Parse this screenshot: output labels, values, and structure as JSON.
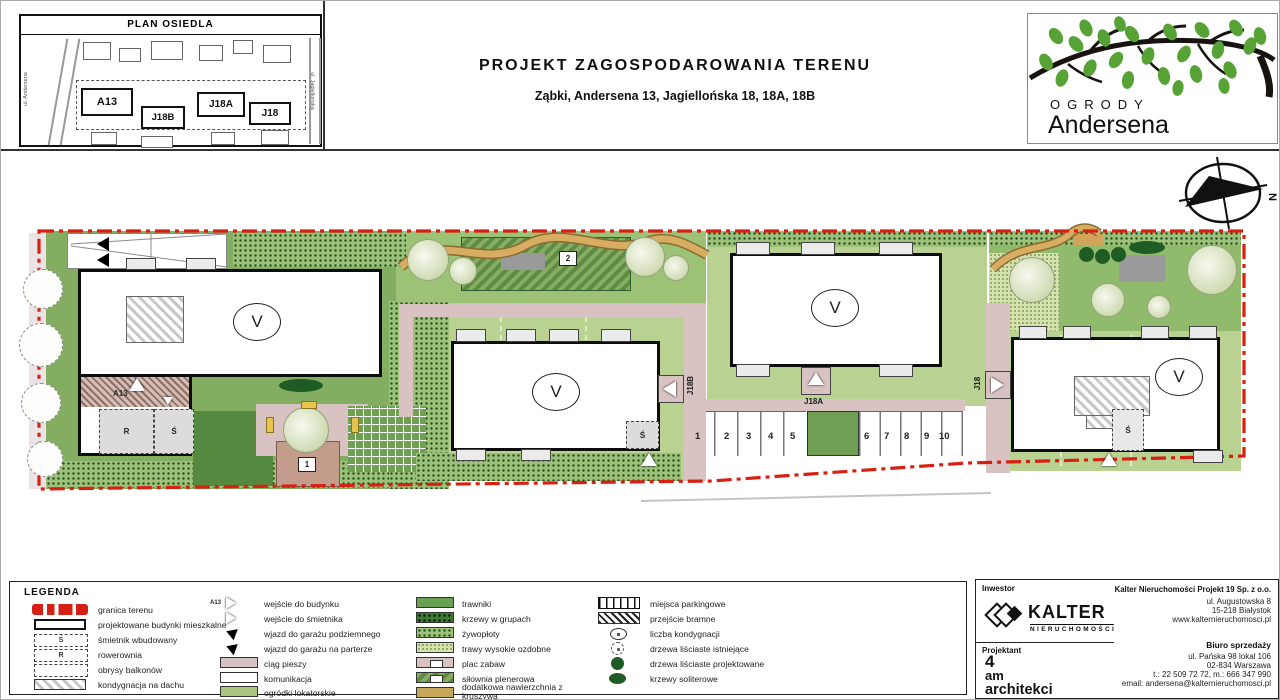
{
  "header": {
    "title": "PROJEKT ZAGOSPODAROWANIA TERENU",
    "subtitle": "Ząbki,  Andersena 13, Jagiellońska 18, 18A, 18B"
  },
  "minimap": {
    "title": "PLAN OSIEDLA",
    "street_left": "ul. Andersena",
    "street_right": "ul. Jagiellońska",
    "buildings": [
      "A13",
      "J18B",
      "J18A",
      "J18"
    ]
  },
  "logo": {
    "line1": "OGRODY",
    "line2": "Andersena"
  },
  "compass": {
    "north": "N"
  },
  "plan": {
    "storey_labels": [
      "V",
      "V",
      "V",
      "V"
    ],
    "entrances": {
      "a13": "A13",
      "j18b": "J18B",
      "j18a": "J18A",
      "j18": "J18"
    },
    "rooms": {
      "bike": "R",
      "trash": "Ś"
    },
    "markers": {
      "playground": "1",
      "gym": "2"
    },
    "parking": [
      "1",
      "2",
      "3",
      "4",
      "5",
      "6",
      "7",
      "8",
      "9",
      "10"
    ]
  },
  "legend": {
    "title": "LEGENDA",
    "entry_symbol_label": "A13",
    "col1": [
      {
        "label": "granica terenu"
      },
      {
        "label": "projektowane budynki mieszkalne"
      },
      {
        "label": "śmietnik wbudowany"
      },
      {
        "label": "rowerownia"
      },
      {
        "label": "obrysy balkonów"
      },
      {
        "label": "kondygnacja na dachu"
      }
    ],
    "col2": [
      {
        "label": "wejście do budynku"
      },
      {
        "label": "wejście do śmietnika"
      },
      {
        "label": "wjazd do garażu podziemnego"
      },
      {
        "label": "wjazd do garażu na parterze"
      },
      {
        "label": "ciąg pieszy"
      },
      {
        "label": "komunikacja"
      },
      {
        "label": "ogródki lokatorskie"
      }
    ],
    "col3": [
      {
        "label": "trawniki"
      },
      {
        "label": "krzewy w grupach"
      },
      {
        "label": "żywopłoty"
      },
      {
        "label": "trawy wysokie ozdobne"
      },
      {
        "label": "plac zabaw"
      },
      {
        "label": "siłownia plenerowa"
      },
      {
        "label": "dodatkowa nawierzchnia z kruszywa"
      }
    ],
    "col4": [
      {
        "label": "miejsca parkingowe"
      },
      {
        "label": "przejście bramne"
      },
      {
        "label": "liczba kondygnacji"
      },
      {
        "label": "drzewa liściaste istniejące"
      },
      {
        "label": "drzewa liściaste projektowane"
      },
      {
        "label": "krzewy soliterowe"
      }
    ]
  },
  "footer": {
    "inwestor_label": "Inwestor",
    "kalter": "KALTER",
    "kalter_sub": "NIERUCHOMOŚCI",
    "projektant_label": "Projektant",
    "architect": [
      "4",
      "am",
      "architekci"
    ],
    "company": {
      "name": "Kalter Nieruchomości Projekt 19 Sp. z o.o.",
      "addr1": "ul. Augustowska 8",
      "addr2": "15-218 Białystok",
      "www": "www.kalternieruchomosci.pl"
    },
    "sales": {
      "title": "Biuro sprzedaży",
      "addr1": "ul. Pańska 98 lokal 106",
      "addr2": "02-834 Warszawa",
      "phone": "t.: 22 509 72 72, m.: 666 347 990",
      "email": "email: andersena@kalternieruchomosci.pl"
    }
  },
  "colors": {
    "boundary": "#d42015",
    "lawn": "#83ad60",
    "garden_light": "#b9d191",
    "path_pink": "#d9c2c2",
    "path_tan": "#caa055",
    "tree_dark": "#1f5b25"
  }
}
